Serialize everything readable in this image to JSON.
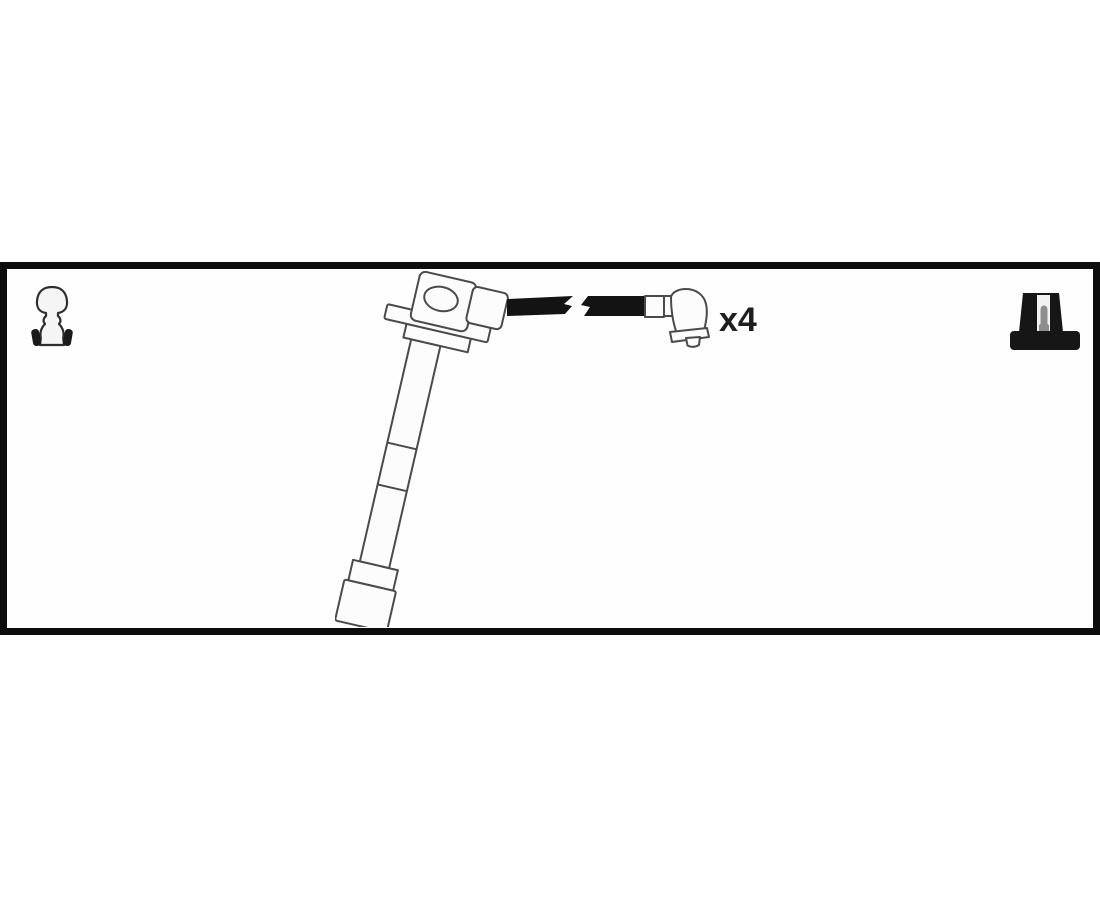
{
  "panel": {
    "quantity_label": "x4",
    "border_color": "#0c0c0c",
    "background": "#fefefe"
  },
  "illustration": {
    "subject": "ignition-cable-kit-line-drawing",
    "line_color": "#4a4a4a",
    "cable_color": "#131313",
    "fill_color": "#fcfcfc"
  },
  "icons": {
    "left": "spark-plug-connector-icon",
    "right": "coil-boot-silhouette-icon"
  }
}
